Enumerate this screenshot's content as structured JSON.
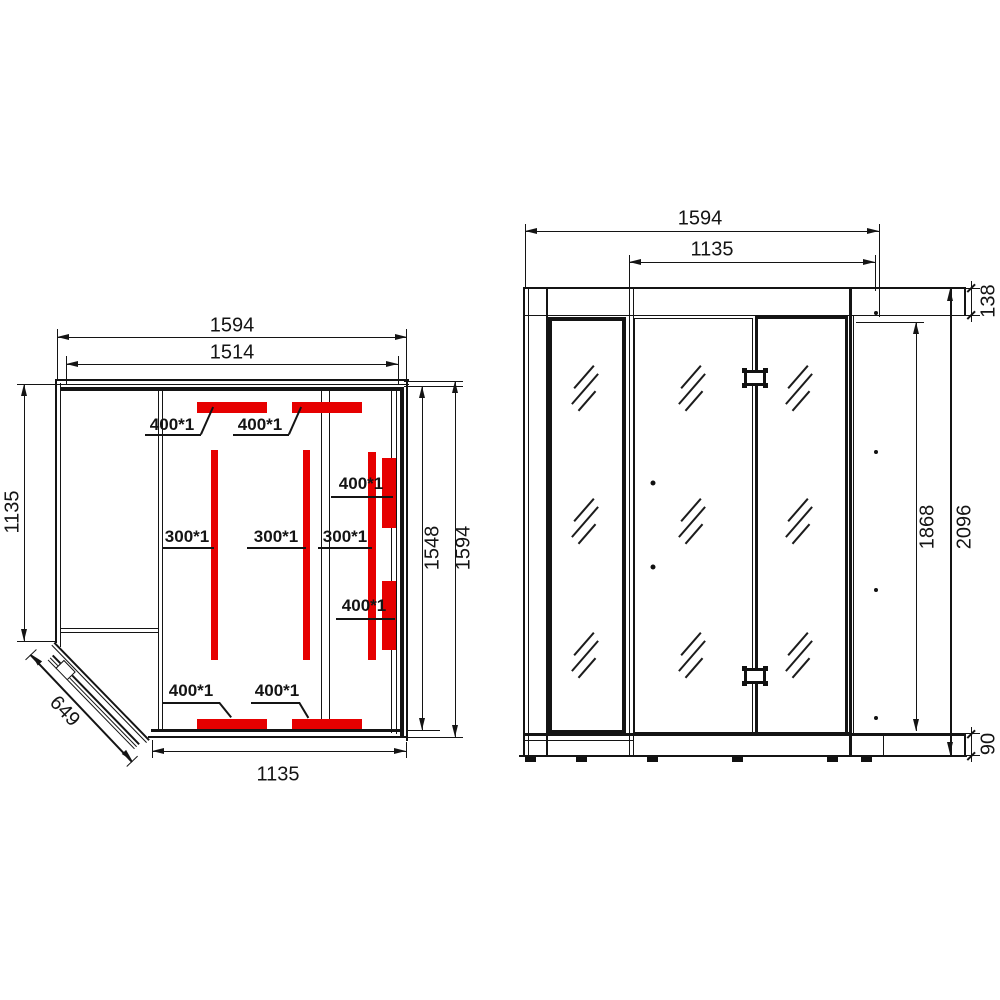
{
  "drawing": {
    "plan": {
      "dim_top_outer": "1594",
      "dim_top_inner": "1514",
      "dim_left_depth": "1135",
      "dim_bottom_width": "1135",
      "dim_right_inner": "1548",
      "dim_right_outer": "1594",
      "dim_door_width": "649",
      "heater_400_label": "400*1",
      "heater_300_label": "300*1"
    },
    "elevation": {
      "dim_overall_width": "1594",
      "dim_front_width": "1135",
      "dim_glass_height": "1868",
      "dim_overall_height": "2096",
      "dim_crown_height": "138",
      "dim_base_height": "90"
    },
    "colors": {
      "heater_red": "#e60000",
      "line": "#141414"
    }
  }
}
